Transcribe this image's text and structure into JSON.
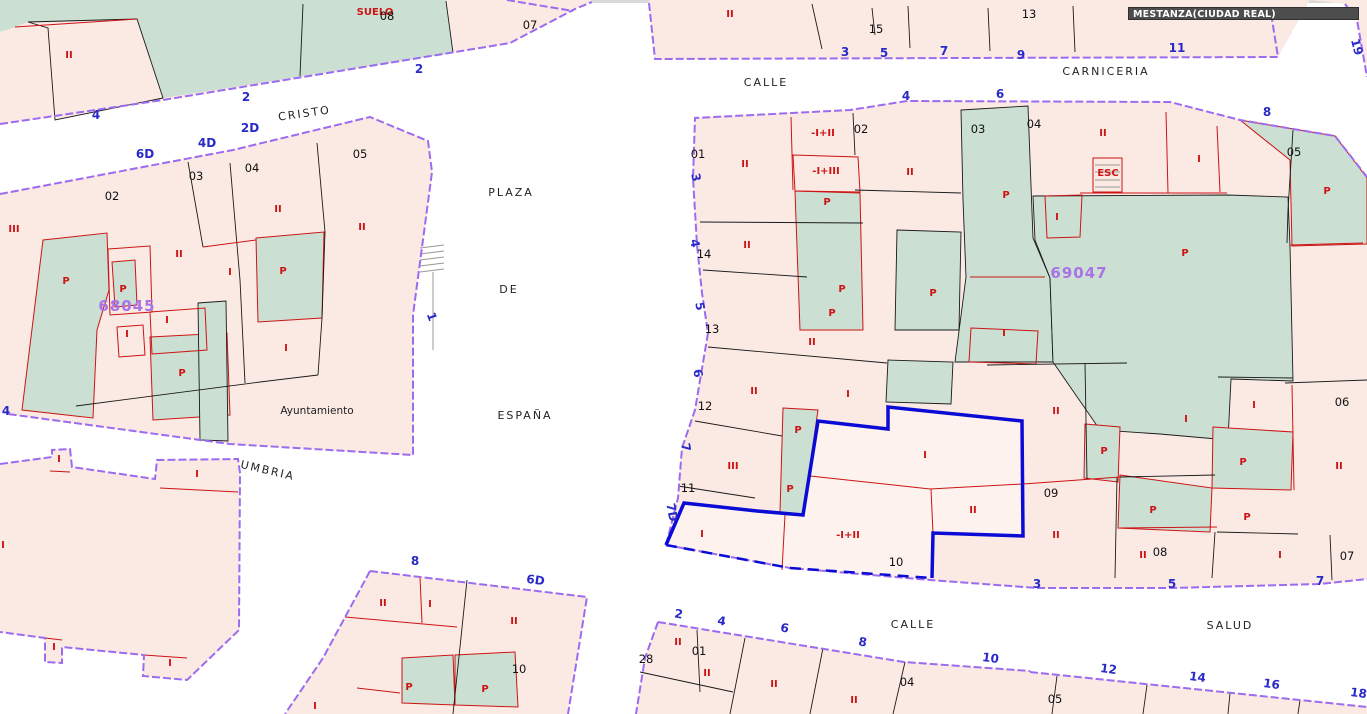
{
  "title_overlay": {
    "text": "MESTANZA(CIUDAD REAL)"
  },
  "colors": {
    "purple_boundary": "#9d6bf0",
    "selection_blue": "#0b0bd6",
    "parcel_pink": "#fbe9e4",
    "parcel_pink_light": "#fdf2ee",
    "parcel_green": "#cbdfd3",
    "red_line": "#cc1414",
    "street_number_blue": "#2a2ac8",
    "block_code_purple": "#a873e8",
    "title_bg": "#4d4d4d"
  },
  "map": {
    "block_codes": [
      {
        "t": "68045",
        "x": 127,
        "y": 311
      },
      {
        "t": "69047",
        "x": 1079,
        "y": 278
      }
    ],
    "street_names": [
      {
        "t": "CRISTO",
        "x": 305,
        "y": 117,
        "r": -8
      },
      {
        "t": "PLAZA",
        "x": 511,
        "y": 196
      },
      {
        "t": "DE",
        "x": 509,
        "y": 293
      },
      {
        "t": "ESPAÑA",
        "x": 525,
        "y": 419
      },
      {
        "t": "CALLE",
        "x": 766,
        "y": 86
      },
      {
        "t": "CARNICERIA",
        "x": 1106,
        "y": 75
      },
      {
        "t": "UMBRIA",
        "x": 267,
        "y": 474,
        "r": 13
      },
      {
        "t": "CALLE",
        "x": 913,
        "y": 628
      },
      {
        "t": "SALUD",
        "x": 1230,
        "y": 629
      }
    ],
    "building_labels": [
      {
        "t": "Ayuntamiento",
        "x": 317,
        "y": 414
      }
    ],
    "street_numbers": [
      {
        "t": "4",
        "x": 96,
        "y": 119
      },
      {
        "t": "2",
        "x": 246,
        "y": 101
      },
      {
        "t": "2",
        "x": 419,
        "y": 73
      },
      {
        "t": "6D",
        "x": 145,
        "y": 158
      },
      {
        "t": "4D",
        "x": 207,
        "y": 147
      },
      {
        "t": "2D",
        "x": 250,
        "y": 132
      },
      {
        "t": "4",
        "x": 6,
        "y": 415
      },
      {
        "t": "1",
        "x": 428,
        "y": 318,
        "r": 70
      },
      {
        "t": "3",
        "x": 845,
        "y": 56
      },
      {
        "t": "5",
        "x": 884,
        "y": 57
      },
      {
        "t": "7",
        "x": 944,
        "y": 55
      },
      {
        "t": "9",
        "x": 1021,
        "y": 59
      },
      {
        "t": "11",
        "x": 1177,
        "y": 52
      },
      {
        "t": "19",
        "x": 1353,
        "y": 48,
        "r": 75
      },
      {
        "t": "4",
        "x": 906,
        "y": 100
      },
      {
        "t": "6",
        "x": 1000,
        "y": 98
      },
      {
        "t": "8",
        "x": 1267,
        "y": 116
      },
      {
        "t": "3",
        "x": 692,
        "y": 178,
        "r": 80
      },
      {
        "t": "4",
        "x": 691,
        "y": 244,
        "r": 80
      },
      {
        "t": "5",
        "x": 696,
        "y": 307,
        "r": 80
      },
      {
        "t": "6",
        "x": 694,
        "y": 374,
        "r": 80
      },
      {
        "t": "7",
        "x": 682,
        "y": 448,
        "r": 80
      },
      {
        "t": "7D",
        "x": 668,
        "y": 513,
        "r": 80
      },
      {
        "t": "3",
        "x": 1037,
        "y": 588
      },
      {
        "t": "5",
        "x": 1172,
        "y": 588
      },
      {
        "t": "7",
        "x": 1320,
        "y": 585
      },
      {
        "t": "8",
        "x": 415,
        "y": 565
      },
      {
        "t": "6D",
        "x": 535,
        "y": 584,
        "r": 8
      },
      {
        "t": "2",
        "x": 678,
        "y": 618,
        "r": 10
      },
      {
        "t": "4",
        "x": 721,
        "y": 625,
        "r": 10
      },
      {
        "t": "6",
        "x": 784,
        "y": 632,
        "r": 10
      },
      {
        "t": "8",
        "x": 862,
        "y": 646,
        "r": 10
      },
      {
        "t": "10",
        "x": 990,
        "y": 662,
        "r": 8
      },
      {
        "t": "12",
        "x": 1108,
        "y": 673,
        "r": 8
      },
      {
        "t": "14",
        "x": 1197,
        "y": 681,
        "r": 8
      },
      {
        "t": "16",
        "x": 1271,
        "y": 688,
        "r": 8
      },
      {
        "t": "18",
        "x": 1358,
        "y": 697,
        "r": 8
      }
    ],
    "parcel_numbers": [
      {
        "t": "08",
        "x": 387,
        "y": 20
      },
      {
        "t": "07",
        "x": 530,
        "y": 29
      },
      {
        "t": "02",
        "x": 112,
        "y": 200
      },
      {
        "t": "03",
        "x": 196,
        "y": 180
      },
      {
        "t": "04",
        "x": 252,
        "y": 172
      },
      {
        "t": "05",
        "x": 360,
        "y": 158
      },
      {
        "t": "15",
        "x": 876,
        "y": 33
      },
      {
        "t": "13",
        "x": 1029,
        "y": 18
      },
      {
        "t": "01",
        "x": 698,
        "y": 158
      },
      {
        "t": "02",
        "x": 861,
        "y": 133
      },
      {
        "t": "03",
        "x": 978,
        "y": 133
      },
      {
        "t": "04",
        "x": 1034,
        "y": 128
      },
      {
        "t": "05",
        "x": 1294,
        "y": 156
      },
      {
        "t": "14",
        "x": 704,
        "y": 258
      },
      {
        "t": "13",
        "x": 712,
        "y": 333
      },
      {
        "t": "12",
        "x": 705,
        "y": 410
      },
      {
        "t": "11",
        "x": 688,
        "y": 492
      },
      {
        "t": "10",
        "x": 896,
        "y": 566
      },
      {
        "t": "09",
        "x": 1051,
        "y": 497
      },
      {
        "t": "08",
        "x": 1160,
        "y": 556
      },
      {
        "t": "06",
        "x": 1342,
        "y": 406
      },
      {
        "t": "07",
        "x": 1347,
        "y": 560
      },
      {
        "t": "10",
        "x": 519,
        "y": 673
      },
      {
        "t": "28",
        "x": 646,
        "y": 663
      },
      {
        "t": "01",
        "x": 699,
        "y": 655
      },
      {
        "t": "04",
        "x": 907,
        "y": 686
      },
      {
        "t": "05",
        "x": 1055,
        "y": 703
      }
    ],
    "construction_labels": [
      {
        "t": "SUELO",
        "x": 375,
        "y": 15
      },
      {
        "t": "II",
        "x": 69,
        "y": 58
      },
      {
        "t": "III",
        "x": 14,
        "y": 232
      },
      {
        "t": "P",
        "x": 66,
        "y": 284
      },
      {
        "t": "P",
        "x": 123,
        "y": 292
      },
      {
        "t": "II",
        "x": 179,
        "y": 257
      },
      {
        "t": "I",
        "x": 167,
        "y": 323
      },
      {
        "t": "I",
        "x": 127,
        "y": 337
      },
      {
        "t": "P",
        "x": 182,
        "y": 376
      },
      {
        "t": "II",
        "x": 278,
        "y": 212
      },
      {
        "t": "I",
        "x": 230,
        "y": 275
      },
      {
        "t": "P",
        "x": 283,
        "y": 274
      },
      {
        "t": "I",
        "x": 286,
        "y": 351
      },
      {
        "t": "II",
        "x": 362,
        "y": 230
      },
      {
        "t": "II",
        "x": 730,
        "y": 17
      },
      {
        "t": "II",
        "x": 745,
        "y": 167
      },
      {
        "t": "-I+II",
        "x": 823,
        "y": 136
      },
      {
        "t": "-I+III",
        "x": 826,
        "y": 174
      },
      {
        "t": "P",
        "x": 827,
        "y": 205
      },
      {
        "t": "II",
        "x": 910,
        "y": 175
      },
      {
        "t": "II",
        "x": 1103,
        "y": 136
      },
      {
        "t": "ESC",
        "x": 1108,
        "y": 176
      },
      {
        "t": "I",
        "x": 1057,
        "y": 220
      },
      {
        "t": "P",
        "x": 1006,
        "y": 198
      },
      {
        "t": "I",
        "x": 1199,
        "y": 162
      },
      {
        "t": "P",
        "x": 1327,
        "y": 194
      },
      {
        "t": "P",
        "x": 1185,
        "y": 256
      },
      {
        "t": "II",
        "x": 747,
        "y": 248
      },
      {
        "t": "P",
        "x": 842,
        "y": 292
      },
      {
        "t": "P",
        "x": 832,
        "y": 316
      },
      {
        "t": "P",
        "x": 933,
        "y": 296
      },
      {
        "t": "II",
        "x": 812,
        "y": 345
      },
      {
        "t": "II",
        "x": 754,
        "y": 394
      },
      {
        "t": "I",
        "x": 848,
        "y": 397
      },
      {
        "t": "I",
        "x": 1004,
        "y": 336
      },
      {
        "t": "P",
        "x": 798,
        "y": 433
      },
      {
        "t": "P",
        "x": 790,
        "y": 492
      },
      {
        "t": "III",
        "x": 733,
        "y": 469
      },
      {
        "t": "I",
        "x": 702,
        "y": 537
      },
      {
        "t": "-I+II",
        "x": 848,
        "y": 538
      },
      {
        "t": "I",
        "x": 925,
        "y": 458
      },
      {
        "t": "II",
        "x": 973,
        "y": 513
      },
      {
        "t": "II",
        "x": 1056,
        "y": 414
      },
      {
        "t": "II",
        "x": 1056,
        "y": 538
      },
      {
        "t": "P",
        "x": 1153,
        "y": 513
      },
      {
        "t": "P",
        "x": 1104,
        "y": 454
      },
      {
        "t": "II",
        "x": 1143,
        "y": 558
      },
      {
        "t": "I",
        "x": 1186,
        "y": 422
      },
      {
        "t": "I",
        "x": 1254,
        "y": 408
      },
      {
        "t": "P",
        "x": 1243,
        "y": 465
      },
      {
        "t": "II",
        "x": 1339,
        "y": 469
      },
      {
        "t": "P",
        "x": 1247,
        "y": 520
      },
      {
        "t": "I",
        "x": 1280,
        "y": 558
      },
      {
        "t": "II",
        "x": 383,
        "y": 606
      },
      {
        "t": "I",
        "x": 430,
        "y": 607
      },
      {
        "t": "II",
        "x": 514,
        "y": 624
      },
      {
        "t": "P",
        "x": 409,
        "y": 690
      },
      {
        "t": "P",
        "x": 485,
        "y": 692
      },
      {
        "t": "I",
        "x": 315,
        "y": 709
      },
      {
        "t": "II",
        "x": 678,
        "y": 645
      },
      {
        "t": "II",
        "x": 707,
        "y": 676
      },
      {
        "t": "II",
        "x": 774,
        "y": 687
      },
      {
        "t": "II",
        "x": 854,
        "y": 703
      },
      {
        "t": "I",
        "x": 59,
        "y": 462
      },
      {
        "t": "I",
        "x": 197,
        "y": 477
      },
      {
        "t": "I",
        "x": 54,
        "y": 650
      },
      {
        "t": "I",
        "x": 170,
        "y": 666
      },
      {
        "t": "I",
        "x": 3,
        "y": 548
      }
    ]
  }
}
